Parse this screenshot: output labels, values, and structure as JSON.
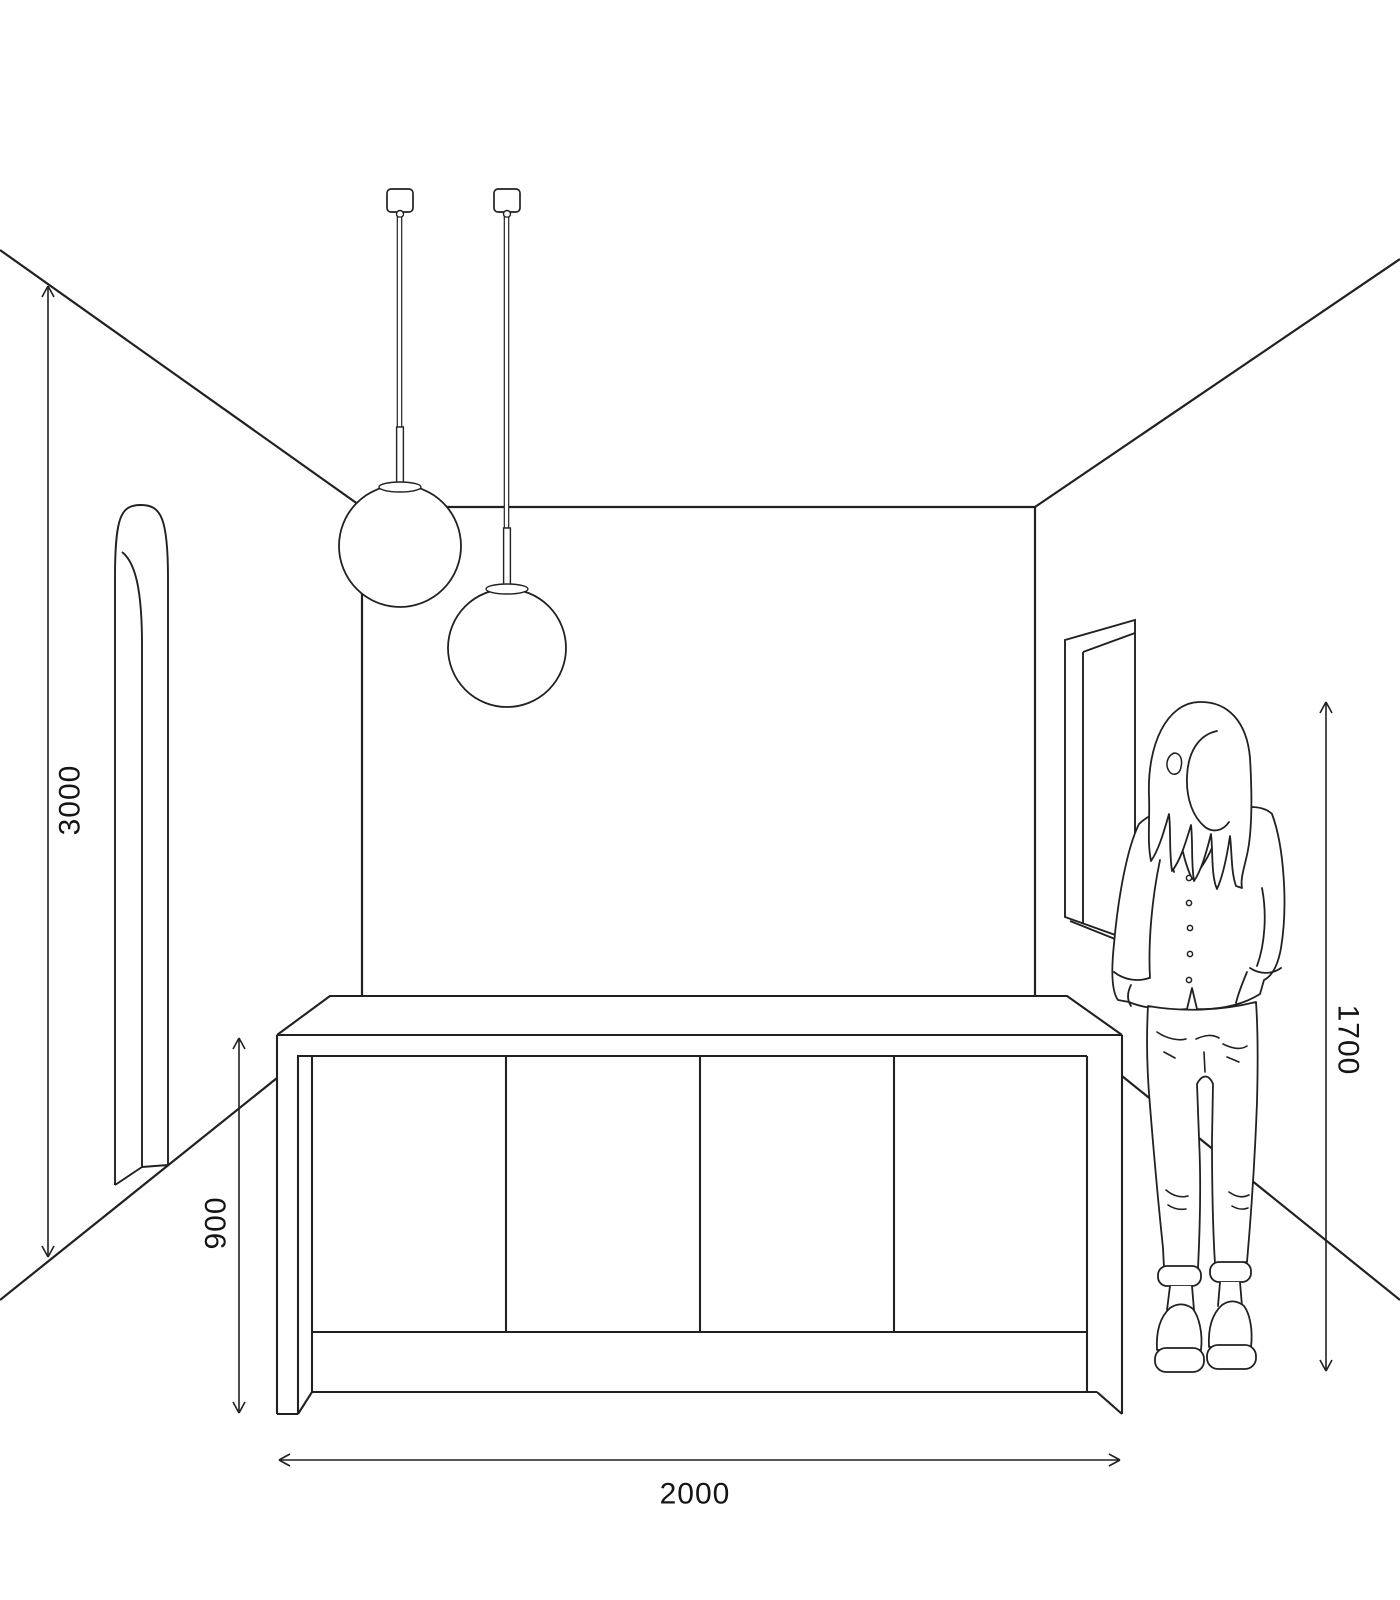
{
  "canvas": {
    "background": "#ffffff",
    "line_color": "#212121",
    "text_color": "#141414"
  },
  "dimensions": {
    "wall_height_mm": "3000",
    "counter_height_mm": "900",
    "person_height_mm": "1700",
    "counter_width_mm": "2000"
  },
  "objects": {
    "pendant_light_count": 2,
    "cabinet_door_count": 4,
    "scene_items": [
      "room-corner-perspective",
      "arched-doorway",
      "pendant-globe-light-left",
      "pendant-globe-light-right",
      "kitchen-island",
      "wall-window",
      "standing-person"
    ]
  }
}
